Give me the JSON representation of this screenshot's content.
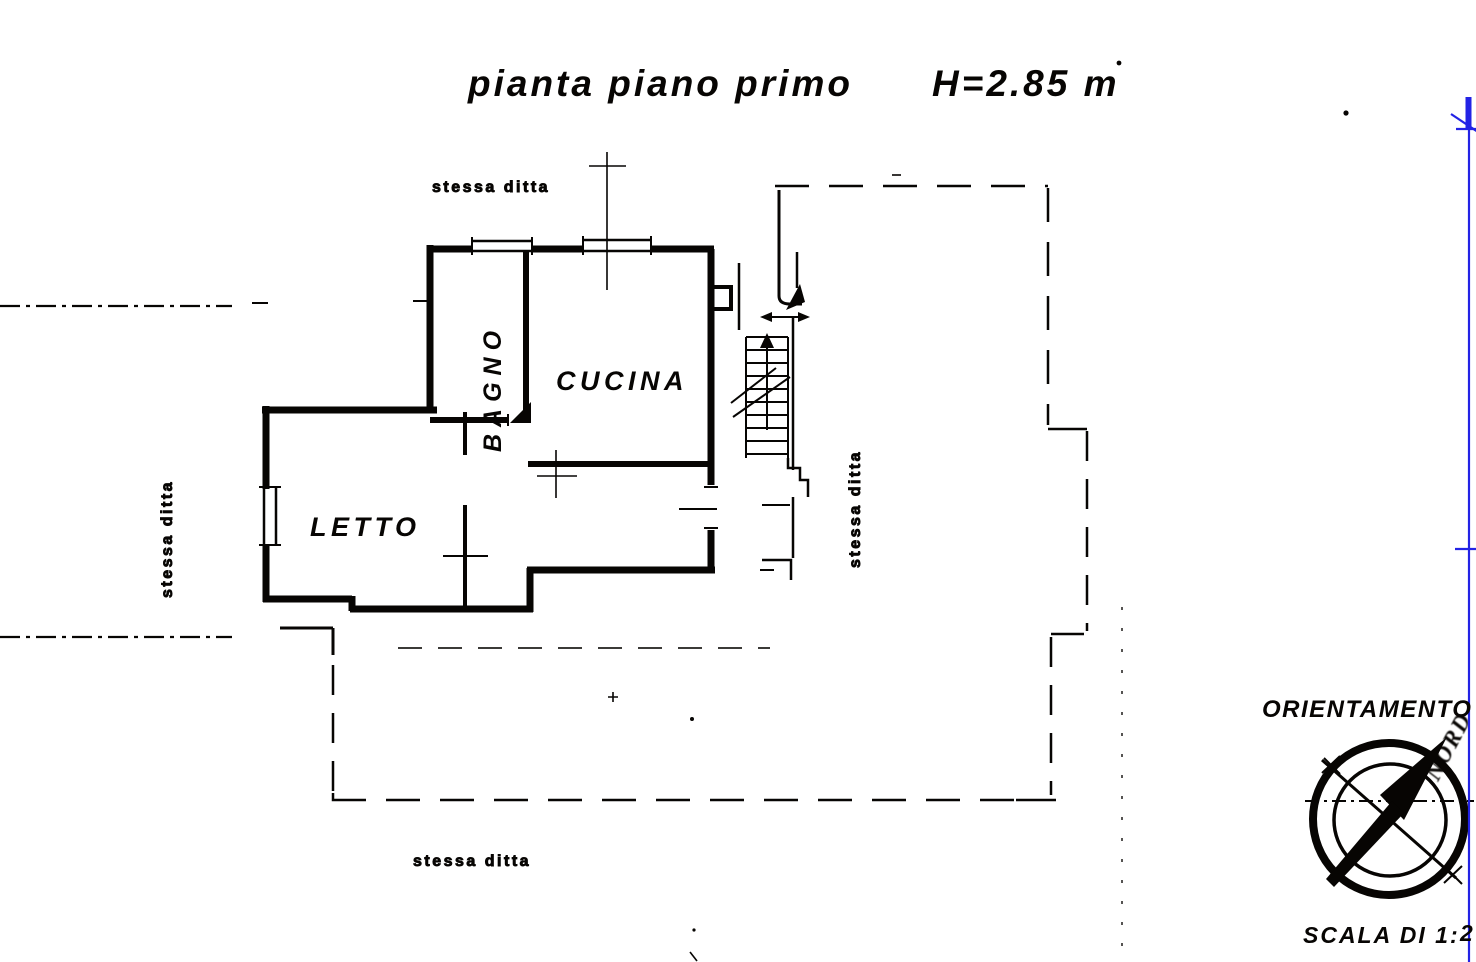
{
  "document": {
    "title": "pianta piano primo",
    "height_note": "H=2.85 m"
  },
  "rooms": {
    "bagno": {
      "label": "BAGNO"
    },
    "cucina": {
      "label": "CUCINA"
    },
    "letto": {
      "label": "LETTO"
    }
  },
  "adjacent_property_labels": {
    "top": "stessa ditta",
    "left": "stessa ditta",
    "right": "stessa ditta",
    "bottom": "stessa ditta"
  },
  "compass": {
    "title": "ORIENTAMENTO",
    "north_label": "NORD"
  },
  "scale": {
    "label": "SCALA DI 1:",
    "value_partial": "2"
  },
  "colors": {
    "ink": "#171513",
    "blue": "#2f2fd8",
    "paper": "#ffffff"
  }
}
